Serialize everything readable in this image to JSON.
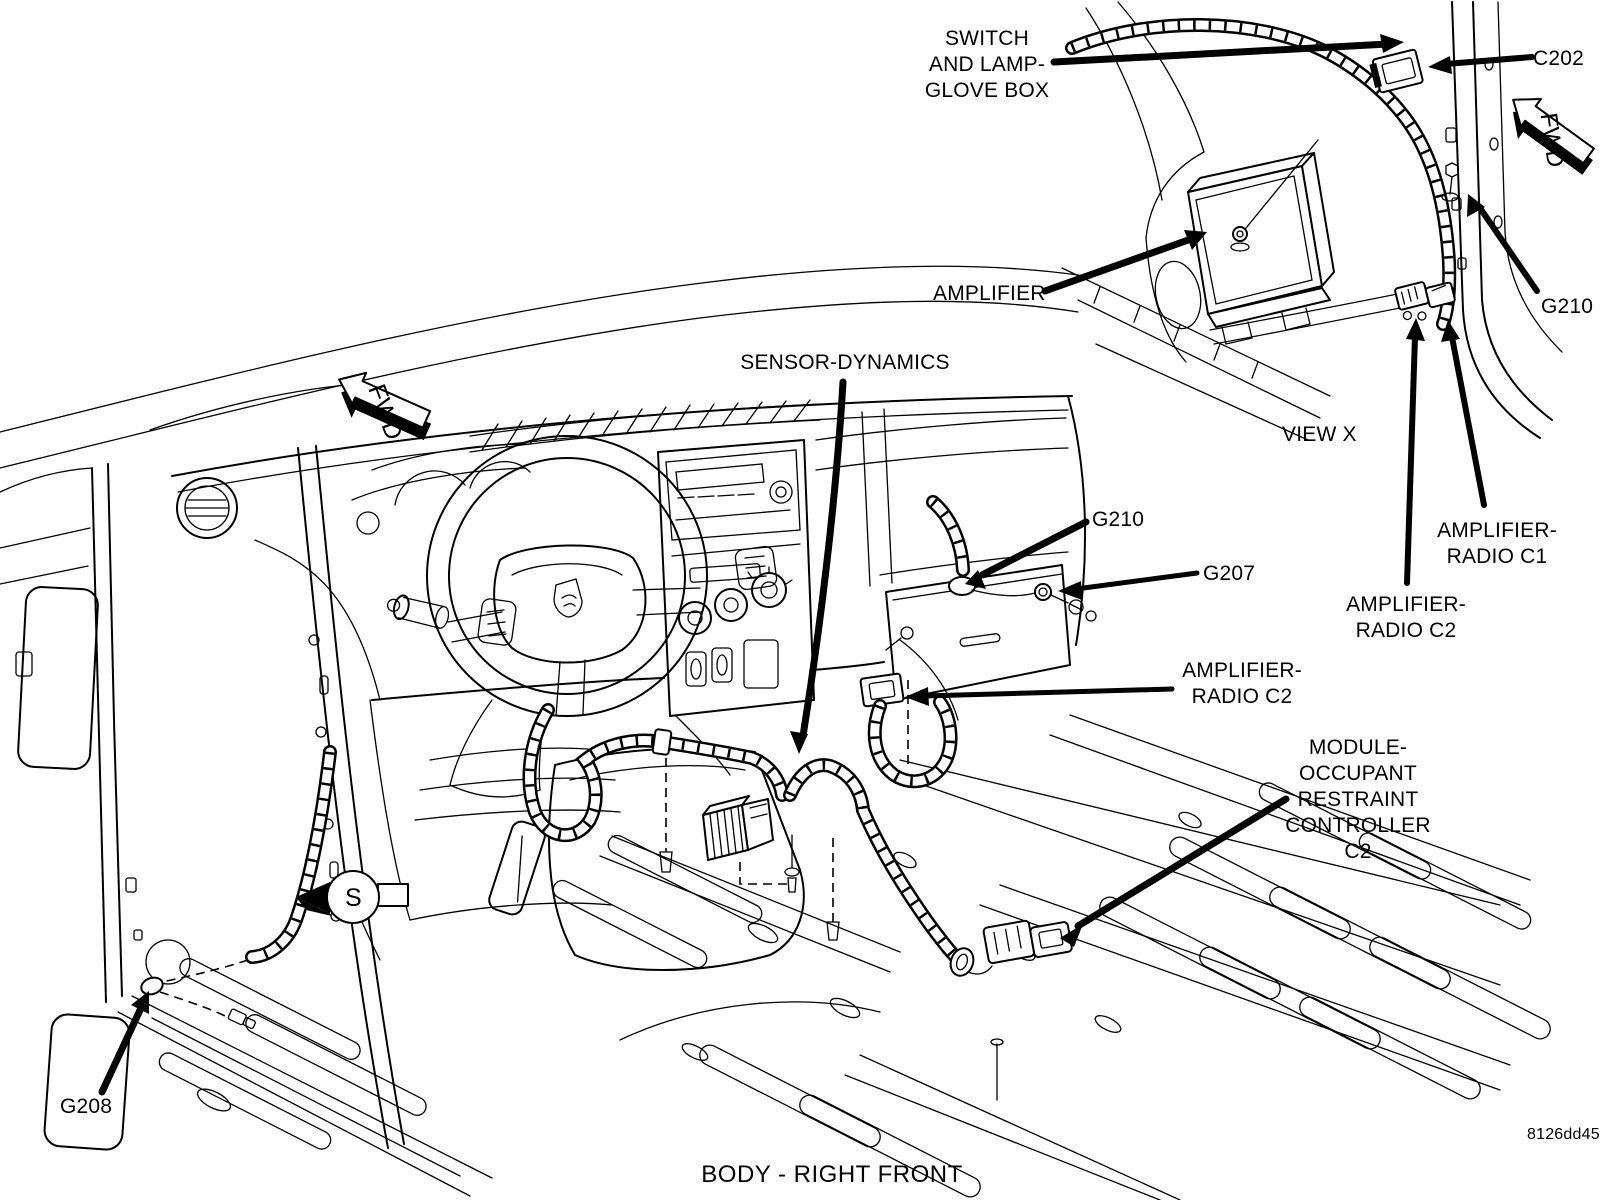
{
  "figure": {
    "caption": "BODY - RIGHT FRONT",
    "code": "8126dd45"
  },
  "inset": {
    "view_label": "VIEW X",
    "fwd_label": "FWD"
  },
  "main": {
    "fwd_label": "FWD",
    "s_label": "S"
  },
  "callouts": {
    "switch_glove_box": "SWITCH\nAND LAMP-\nGLOVE BOX",
    "c202": "C202",
    "amplifier": "AMPLIFIER",
    "g210_inset": "G210",
    "amp_radio_c1": "AMPLIFIER-\nRADIO C1",
    "amp_radio_c2_inset": "AMPLIFIER-\nRADIO C2",
    "g210_main": "G210",
    "g207": "G207",
    "amp_radio_c2_main": "AMPLIFIER-\nRADIO C2",
    "sensor_dynamics": "SENSOR-DYNAMICS",
    "module_orc": "MODULE-\nOCCUPANT\nRESTRAINT\nCONTROLLER\nC2",
    "g208": "G208"
  }
}
